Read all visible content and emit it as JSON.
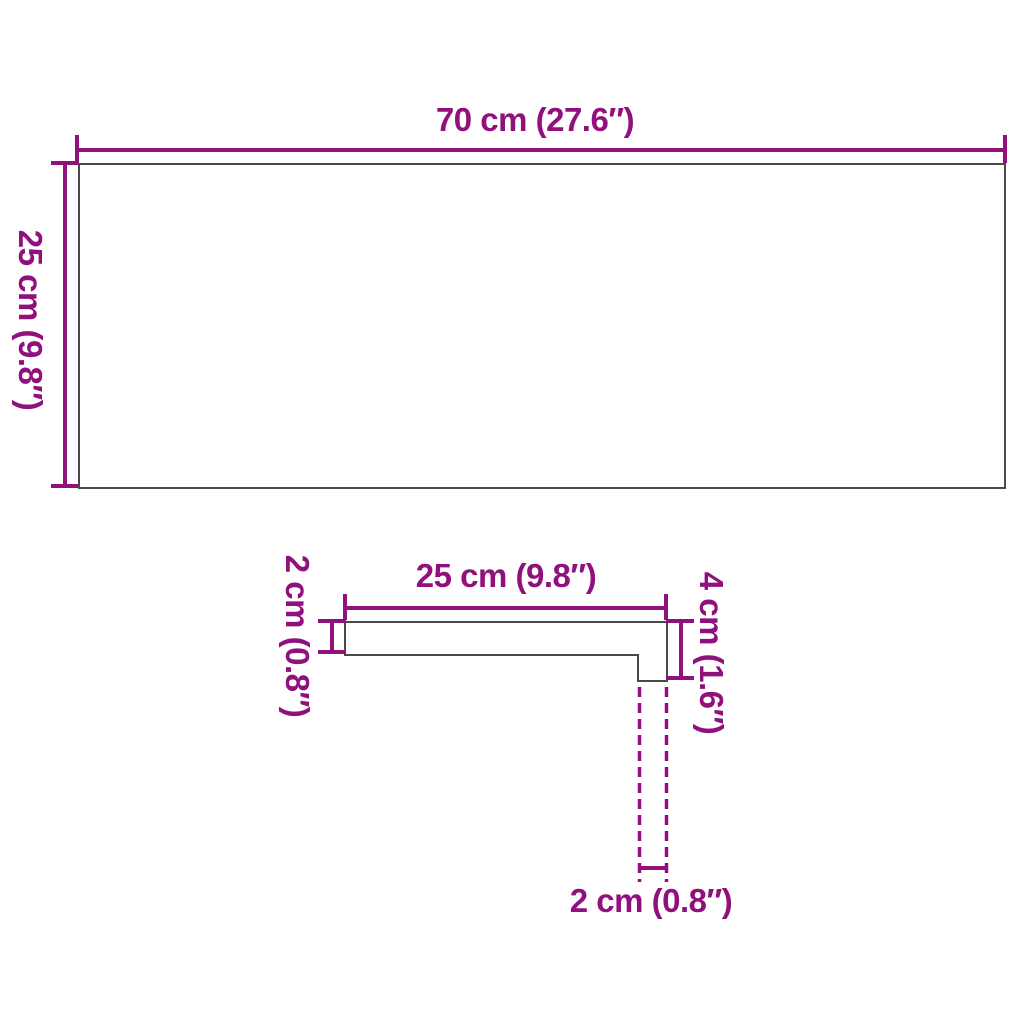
{
  "colors": {
    "accent": "#90107D",
    "outline": "#4A4A4A",
    "background": "#FFFFFF"
  },
  "diagram": {
    "top_view": {
      "width_label": "70 cm (27.6″)",
      "height_label": "25 cm (9.8″)"
    },
    "profile_view": {
      "width_label": "25 cm (9.8″)",
      "thickness_label": "2 cm (0.8″)",
      "height_label": "4 cm (1.6″)",
      "nose_label": "2 cm (0.8″)"
    }
  }
}
